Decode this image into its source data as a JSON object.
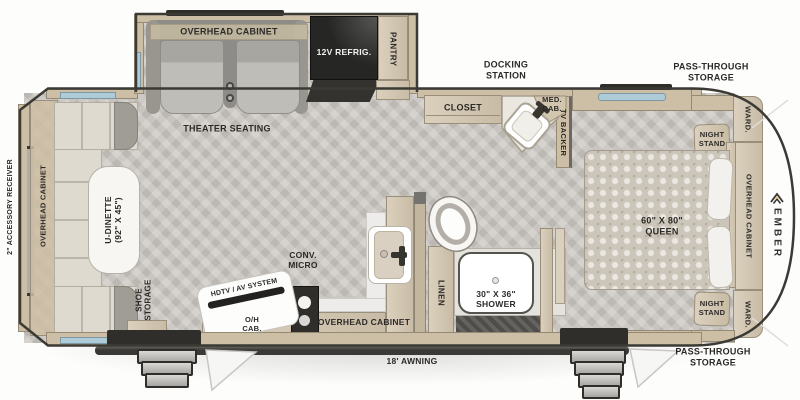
{
  "plan_labels": {
    "overhead_cabinet": "OVERHEAD CABINET",
    "theater_seating": "THEATER SEATING",
    "refrigerator": "12V REFRIG.",
    "pantry": "PANTRY",
    "docking_station": "DOCKING STATION",
    "med_cab": "MED. CAB.",
    "closet": "CLOSET",
    "tv_backer": "TV BACKER",
    "pass_through": "PASS-THROUGH STORAGE",
    "night_stand": "NIGHT STAND",
    "ward": "WARD.",
    "accessory_receiver": "2\" ACCESSORY RECEIVER",
    "u_dinette": "U-DINETTE (92\" X 45\")",
    "shoe_storage": "SHOE STORAGE",
    "conv_micro": "CONV. MICRO",
    "hdtv_av": "HDTV / AV SYSTEM",
    "oh_cab": "O/H CAB.",
    "linen": "LINEN",
    "shower": "30\" X 36\" SHOWER",
    "queen_bed": "60\" X 80\" QUEEN",
    "awning": "18' AWNING",
    "brand": "EMBER"
  },
  "colors": {
    "wall_tan": "#d3c6af",
    "floor_gray": "#c8c4bf",
    "dark_trim": "#38362f",
    "window_blue": "#aecbd8",
    "cushion_cream": "#dedacf",
    "seat_gray": "#a8a6a2",
    "logo_accent": "#e8a33d",
    "label_text": "#2c2a27"
  }
}
